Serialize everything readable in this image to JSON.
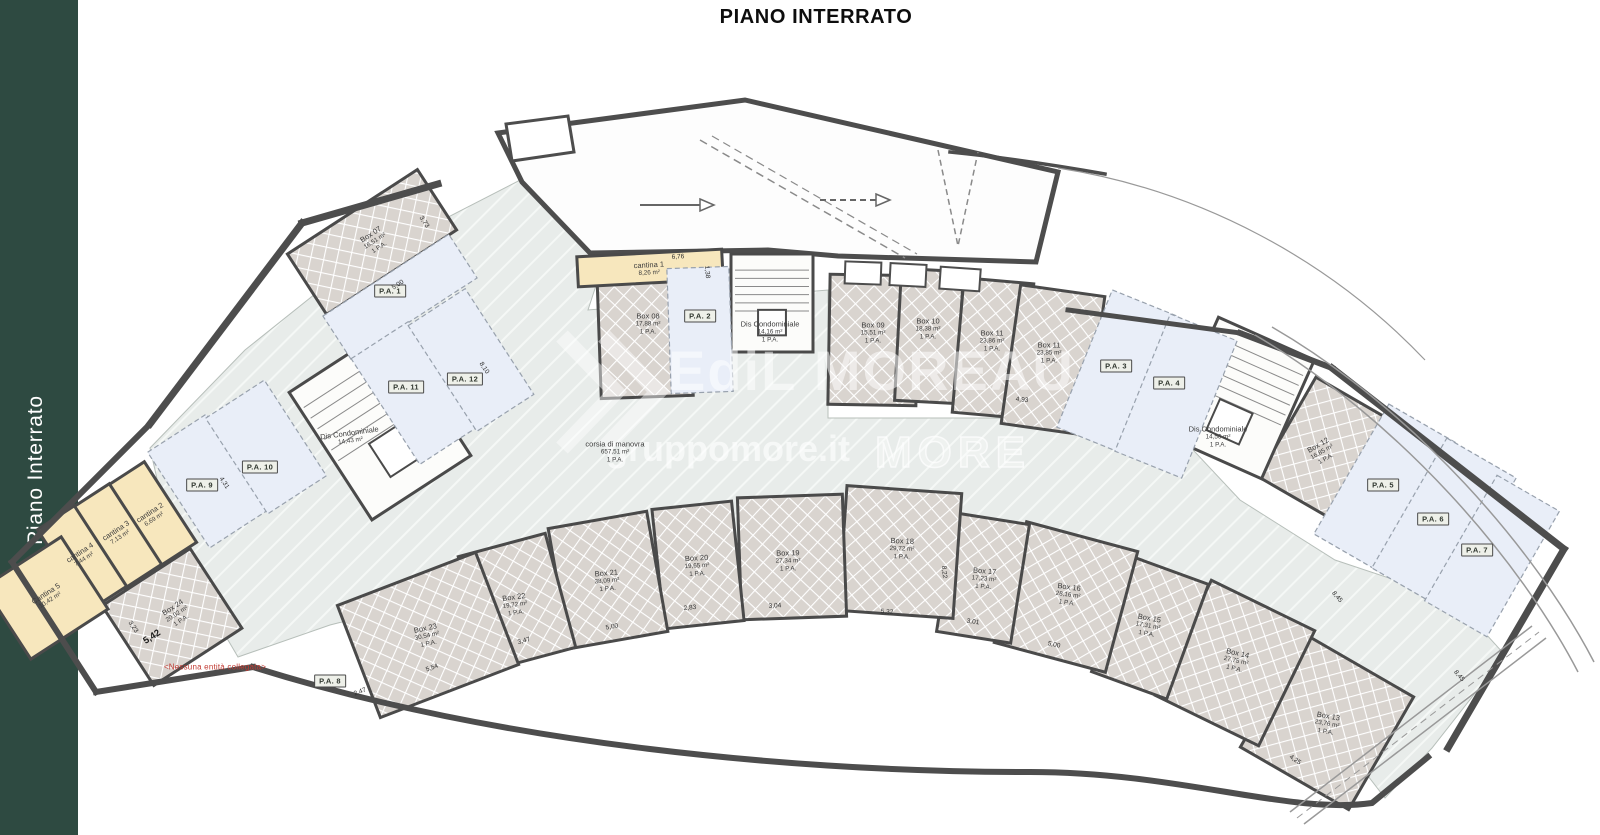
{
  "page": {
    "title": "PIANO INTERRATO",
    "sidebar_label": "Piano Interrato",
    "note": "<Nessuna entità collegata>"
  },
  "watermark": {
    "brand": "EdiL MOREAU",
    "site": "gruppomore.it",
    "logo": "MORE"
  },
  "colors": {
    "sidebar": "#2e4a41",
    "wall": "#4a4a4a",
    "box_fill": "#d9d4cf",
    "lane_fill": "#e8ecea",
    "parking_fill": "#e9eef8",
    "cantina_fill": "#f7e7bd",
    "alert": "#c13b33"
  },
  "plan": {
    "rooms": [
      {
        "id": "box07",
        "type": "box",
        "name": "Box 07",
        "area": "16,51 m²",
        "pa": "1 P.A.",
        "cx": 372,
        "cy": 242,
        "w": 155,
        "h": 72,
        "rot": -33,
        "lr": -33,
        "lx": 375,
        "ly": 241
      },
      {
        "id": "box08",
        "type": "box",
        "name": "Box 08",
        "area": "17,88 m²",
        "pa": "1 P.A.",
        "cx": 645,
        "cy": 333,
        "w": 92,
        "h": 128,
        "rot": -2,
        "lr": 0,
        "lx": 648,
        "ly": 324
      },
      {
        "id": "box09",
        "type": "box",
        "name": "Box 09",
        "area": "15,51 m²",
        "pa": "1 P.A.",
        "cx": 873,
        "cy": 340,
        "w": 88,
        "h": 130,
        "rot": 1,
        "lr": 0,
        "lx": 873,
        "ly": 333
      },
      {
        "id": "box10",
        "type": "box",
        "name": "Box 10",
        "area": "18,38 m²",
        "pa": "1 P.A.",
        "cx": 929,
        "cy": 336,
        "w": 62,
        "h": 132,
        "rot": 3,
        "lr": 0,
        "lx": 928,
        "ly": 329
      },
      {
        "id": "box11a",
        "type": "box",
        "name": "Box 11",
        "area": "23,86 m²",
        "pa": "1 P.A.",
        "cx": 993,
        "cy": 348,
        "w": 70,
        "h": 135,
        "rot": 5,
        "lr": 0,
        "lx": 992,
        "ly": 341
      },
      {
        "id": "box11b",
        "type": "box",
        "name": "Box 11",
        "area": "23,85 m²",
        "pa": "1 P.A.",
        "cx": 1053,
        "cy": 360,
        "w": 85,
        "h": 140,
        "rot": 8,
        "lr": 0,
        "lx": 1049,
        "ly": 353
      },
      {
        "id": "box12",
        "type": "box",
        "name": "Box 12",
        "area": "16,85 m²",
        "pa": "1 P.A.",
        "cx": 1327,
        "cy": 450,
        "w": 92,
        "h": 115,
        "rot": 30,
        "lr": -30,
        "lx": 1322,
        "ly": 452
      },
      {
        "id": "box13",
        "type": "box",
        "name": "Box 13",
        "area": "23,76 m²",
        "pa": "1 P.A.",
        "cx": 1327,
        "cy": 722,
        "w": 125,
        "h": 130,
        "rot": 30,
        "lr": 10,
        "lx": 1327,
        "ly": 724
      },
      {
        "id": "box14",
        "type": "box",
        "name": "Box 14",
        "area": "27,75 m²",
        "pa": "1 P.A.",
        "cx": 1235,
        "cy": 663,
        "w": 115,
        "h": 128,
        "rot": 26,
        "lr": 13,
        "lx": 1236,
        "ly": 661
      },
      {
        "id": "box15",
        "type": "box",
        "name": "Box 15",
        "area": "17,31 m²",
        "pa": "1 P.A.",
        "cx": 1150,
        "cy": 628,
        "w": 80,
        "h": 122,
        "rot": 20,
        "lr": 10,
        "lx": 1148,
        "ly": 626
      },
      {
        "id": "box16",
        "type": "box",
        "name": "Box 16",
        "area": "28,16 m²",
        "pa": "1 P.A.",
        "cx": 1066,
        "cy": 597,
        "w": 115,
        "h": 125,
        "rot": 15,
        "lr": 8,
        "lx": 1068,
        "ly": 595
      },
      {
        "id": "box17",
        "type": "box",
        "name": "Box 17",
        "area": "17,23 m²",
        "pa": "1 P.A.",
        "cx": 983,
        "cy": 578,
        "w": 75,
        "h": 120,
        "rot": 9,
        "lr": 5,
        "lx": 984,
        "ly": 579
      },
      {
        "id": "box18",
        "type": "box",
        "name": "Box 18",
        "area": "29,72 m²",
        "pa": "1 P.A.",
        "cx": 900,
        "cy": 552,
        "w": 115,
        "h": 125,
        "rot": 4,
        "lr": 2,
        "lx": 902,
        "ly": 549
      },
      {
        "id": "box19",
        "type": "box",
        "name": "Box 19",
        "area": "27,34 m²",
        "pa": "1 P.A.",
        "cx": 792,
        "cy": 557,
        "w": 105,
        "h": 122,
        "rot": -2,
        "lr": -1,
        "lx": 788,
        "ly": 561
      },
      {
        "id": "box20",
        "type": "box",
        "name": "Box 20",
        "area": "19,65 m²",
        "pa": "1 P.A.",
        "cx": 698,
        "cy": 565,
        "w": 80,
        "h": 120,
        "rot": -6,
        "lr": -3,
        "lx": 697,
        "ly": 566
      },
      {
        "id": "box21",
        "type": "box",
        "name": "Box 21",
        "area": "38,09 m²",
        "pa": "1 P.A.",
        "cx": 608,
        "cy": 580,
        "w": 100,
        "h": 122,
        "rot": -10,
        "lr": -5,
        "lx": 607,
        "ly": 581
      },
      {
        "id": "box22",
        "type": "box",
        "name": "Box 22",
        "area": "19,72 m²",
        "pa": "1 P.A.",
        "cx": 517,
        "cy": 602,
        "w": 90,
        "h": 118,
        "rot": -15,
        "lr": -8,
        "lx": 515,
        "ly": 605
      },
      {
        "id": "box23",
        "type": "box",
        "name": "Box 23",
        "area": "30,54 m²",
        "pa": "1 P.A.",
        "cx": 428,
        "cy": 635,
        "w": 148,
        "h": 120,
        "rot": -21,
        "lr": -12,
        "lx": 427,
        "ly": 636
      },
      {
        "id": "box24",
        "type": "box",
        "name": "Box 24",
        "area": "20,02 m²",
        "pa": "1 P.A.",
        "cx": 172,
        "cy": 617,
        "w": 105,
        "h": 95,
        "rot": -33,
        "lr": -33,
        "lx": 177,
        "ly": 614
      },
      {
        "id": "cantina1",
        "type": "cantina",
        "name": "cantina 1",
        "area": "8,26 m²",
        "pa": null,
        "cx": 650,
        "cy": 268,
        "w": 145,
        "h": 30,
        "rot": -3,
        "lr": -3,
        "lx": 649,
        "ly": 269
      },
      {
        "id": "cantina2",
        "type": "cantina",
        "name": "cantina 2",
        "area": "6,69 m²",
        "pa": null,
        "cx": 152,
        "cy": 514,
        "w": 44,
        "h": 96,
        "rot": -33,
        "lr": -33,
        "lx": 152,
        "ly": 516
      },
      {
        "id": "cantina3",
        "type": "cantina",
        "name": "cantina 3",
        "area": "7,13 m²",
        "pa": null,
        "cx": 117,
        "cy": 536,
        "w": 44,
        "h": 96,
        "rot": -33,
        "lr": -33,
        "lx": 118,
        "ly": 534
      },
      {
        "id": "cantina4",
        "type": "cantina",
        "name": "cantina 4",
        "area": "7,44 m²",
        "pa": null,
        "cx": 82,
        "cy": 558,
        "w": 44,
        "h": 96,
        "rot": -33,
        "lr": -33,
        "lx": 82,
        "ly": 556
      },
      {
        "id": "cantina5",
        "type": "cantina",
        "name": "Cantina 5",
        "area": "10,42 m²",
        "pa": null,
        "cx": 46,
        "cy": 598,
        "w": 92,
        "h": 86,
        "rot": -33,
        "lr": -33,
        "lx": 48,
        "ly": 597
      },
      {
        "id": "stair-left",
        "type": "stair",
        "name": "Dis Condominiale",
        "area": "14,43 m²",
        "pa": null,
        "cx": 380,
        "cy": 424,
        "w": 118,
        "h": 152,
        "rot": -33,
        "lr": -8,
        "lx": 350,
        "ly": 437
      },
      {
        "id": "stair-center",
        "type": "stair",
        "name": "Dis Condominiale",
        "area": "14,16 m²",
        "pa": "1 P.A.",
        "cx": 772,
        "cy": 303,
        "w": 82,
        "h": 98,
        "rot": 0,
        "lr": 0,
        "lx": 770,
        "ly": 332
      },
      {
        "id": "stair-right",
        "type": "stair",
        "name": "Dis Condominiale",
        "area": "14,56 m²",
        "pa": "1 P.A.",
        "cx": 1240,
        "cy": 398,
        "w": 105,
        "h": 130,
        "rot": 24,
        "lr": 0,
        "lx": 1218,
        "ly": 437
      },
      {
        "id": "corsia",
        "type": "lane",
        "name": "corsia di manovra",
        "area": "657,51 m²",
        "pa": "1 P.A.",
        "cx": 615,
        "cy": 452,
        "w": 0,
        "h": 0,
        "rot": 0,
        "lr": 0,
        "lx": 615,
        "ly": 452
      },
      {
        "id": "pa1",
        "type": "parking",
        "label": "P.A. 1",
        "cx": 400,
        "cy": 297,
        "w": 150,
        "h": 52,
        "rot": -33,
        "lx": 390,
        "ly": 291
      },
      {
        "id": "pa2",
        "type": "parking",
        "label": "P.A. 2",
        "cx": 700,
        "cy": 330,
        "w": 62,
        "h": 125,
        "rot": -2,
        "lx": 700,
        "ly": 316
      },
      {
        "id": "pa3",
        "type": "parking",
        "label": "P.A. 3",
        "cx": 1118,
        "cy": 372,
        "w": 72,
        "h": 148,
        "rot": 22,
        "lx": 1116,
        "ly": 366
      },
      {
        "id": "pa4",
        "type": "parking",
        "label": "P.A. 4",
        "cx": 1176,
        "cy": 396,
        "w": 72,
        "h": 148,
        "rot": 22,
        "lx": 1169,
        "ly": 383
      },
      {
        "id": "pa5",
        "type": "parking",
        "label": "P.A. 5",
        "cx": 1386,
        "cy": 489,
        "w": 80,
        "h": 150,
        "rot": 30,
        "lx": 1383,
        "ly": 485
      },
      {
        "id": "pa6",
        "type": "parking",
        "label": "P.A. 6",
        "cx": 1444,
        "cy": 523,
        "w": 80,
        "h": 150,
        "rot": 30,
        "lx": 1433,
        "ly": 519
      },
      {
        "id": "pa7",
        "type": "parking",
        "label": "P.A. 7",
        "cx": 1492,
        "cy": 556,
        "w": 72,
        "h": 145,
        "rot": 30,
        "lx": 1477,
        "ly": 550
      },
      {
        "id": "pa8",
        "type": "parking",
        "label": "P.A. 8",
        "cx": 330,
        "cy": 681,
        "w": 0,
        "h": 0,
        "rot": 0,
        "lx": 330,
        "ly": 681
      },
      {
        "id": "pa9",
        "type": "parking",
        "label": "P.A. 9",
        "cx": 208,
        "cy": 481,
        "w": 70,
        "h": 114,
        "rot": -33,
        "lx": 202,
        "ly": 485
      },
      {
        "id": "pa10",
        "type": "parking",
        "label": "P.A. 10",
        "cx": 266,
        "cy": 447,
        "w": 70,
        "h": 114,
        "rot": -33,
        "lx": 260,
        "ly": 467
      },
      {
        "id": "pa11",
        "type": "parking",
        "label": "P.A. 11",
        "cx": 414,
        "cy": 393,
        "w": 68,
        "h": 126,
        "rot": -33,
        "lx": 406,
        "ly": 387
      },
      {
        "id": "pa12",
        "type": "parking",
        "label": "P.A. 12",
        "cx": 471,
        "cy": 360,
        "w": 68,
        "h": 126,
        "rot": -33,
        "lx": 465,
        "ly": 379
      }
    ],
    "dimensions": [
      {
        "t": "6,76",
        "x": 678,
        "y": 257,
        "r": -3
      },
      {
        "t": "1,38",
        "x": 707,
        "y": 272,
        "r": 85
      },
      {
        "t": "5,00",
        "x": 398,
        "y": 285,
        "r": -33
      },
      {
        "t": "3,73",
        "x": 424,
        "y": 222,
        "r": 57
      },
      {
        "t": "8,10",
        "x": 484,
        "y": 368,
        "r": 57
      },
      {
        "t": "4,31",
        "x": 224,
        "y": 483,
        "r": 57
      },
      {
        "t": "5,42",
        "x": 152,
        "y": 637,
        "r": -33,
        "b": 1
      },
      {
        "t": "3,23",
        "x": 133,
        "y": 627,
        "r": 57
      },
      {
        "t": "4,93",
        "x": 1022,
        "y": 400,
        "r": 6
      },
      {
        "t": "2,83",
        "x": 690,
        "y": 608,
        "r": -6
      },
      {
        "t": "3,04",
        "x": 775,
        "y": 606,
        "r": -3
      },
      {
        "t": "5,32",
        "x": 887,
        "y": 612,
        "r": 3
      },
      {
        "t": "3,01",
        "x": 973,
        "y": 622,
        "r": 8
      },
      {
        "t": "5,00",
        "x": 1054,
        "y": 645,
        "r": 12
      },
      {
        "t": "5,00",
        "x": 612,
        "y": 627,
        "r": -10
      },
      {
        "t": "3,47",
        "x": 524,
        "y": 641,
        "r": -15
      },
      {
        "t": "5,54",
        "x": 432,
        "y": 668,
        "r": -20
      },
      {
        "t": "2,47",
        "x": 360,
        "y": 692,
        "r": -20
      },
      {
        "t": "8,22",
        "x": 944,
        "y": 572,
        "r": 85
      },
      {
        "t": "8,45",
        "x": 1337,
        "y": 597,
        "r": 50
      },
      {
        "t": "8,45",
        "x": 1459,
        "y": 676,
        "r": 50
      },
      {
        "t": "4,25",
        "x": 1295,
        "y": 760,
        "r": 35
      }
    ]
  }
}
